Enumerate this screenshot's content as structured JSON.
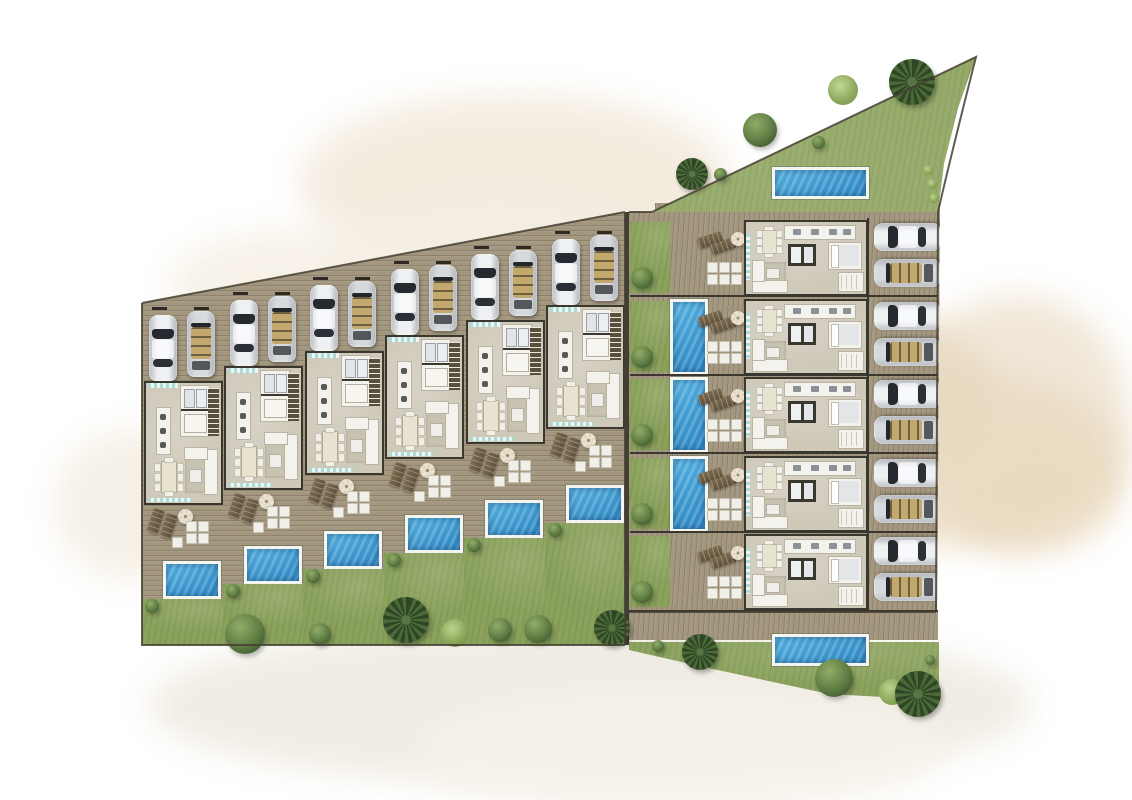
{
  "scene": {
    "title": "Villa development master site plan — watercolor architectural rendering, top view",
    "background_color": "#ffffff",
    "wash_colors": [
      "#f2e9da",
      "#e7d8bf",
      "#ead9bd",
      "#f0ebe2",
      "#f4eee3"
    ]
  },
  "left_row": {
    "name": "west terraced villa row",
    "unit_count": 6,
    "units": [
      {
        "id": "L1"
      },
      {
        "id": "L2"
      },
      {
        "id": "L3"
      },
      {
        "id": "L4"
      },
      {
        "id": "L5"
      },
      {
        "id": "L6"
      }
    ],
    "unit_features": {
      "parking_cars": [
        "white sedan",
        "silver convertible with tan interior"
      ],
      "rooms": [
        "entry with glazing",
        "bathroom and closet rooms",
        "staircase",
        "kitchen island",
        "dining table for 8",
        "living sofa set with rug"
      ],
      "terrace": [
        "2 sun loungers",
        "parasol",
        "outdoor cushion set"
      ],
      "private_pool": "rectangular pool with white surround",
      "garden": "rear lawn with shrub"
    }
  },
  "right_column": {
    "name": "east terraced villa column",
    "unit_count": 5,
    "units": [
      {
        "id": "R1",
        "side_pool": false,
        "nearest_pool": "north amenity pool"
      },
      {
        "id": "R2",
        "side_pool": true
      },
      {
        "id": "R3",
        "side_pool": true
      },
      {
        "id": "R4",
        "side_pool": true
      },
      {
        "id": "R5",
        "side_pool": false,
        "nearest_pool": "south amenity pool"
      }
    ],
    "unit_features": {
      "parking_cars": [
        "silver sedan",
        "silver convertible with tan interior"
      ],
      "rooms": [
        "glazed pool-side facade",
        "dining table for 8",
        "kitchen counter",
        "bathroom core",
        "bedroom",
        "wardrobe",
        "living sofa set with rug"
      ],
      "deck": [
        "2 sun loungers",
        "parasol",
        "outdoor cushion set"
      ],
      "side_garden": "lawn strip with shrub and long plunge pool (units R2–R4)"
    }
  },
  "amenities": {
    "north_garden": {
      "shape": "triangular lawn at top-right",
      "pool": "rectangular amenity pool",
      "planting": [
        "palm tree",
        "fern",
        "round tree",
        "shrubs"
      ]
    },
    "south_garden": {
      "shape": "sloping lawn band at bottom-right with boardwalk",
      "pool": "rectangular amenity pool",
      "planting": [
        "palm trees",
        "round tree",
        "fern",
        "shrubs"
      ]
    },
    "west_garden_edge": {
      "planting": [
        "round bushes",
        "palm trees",
        "ferns"
      ]
    }
  },
  "totals": {
    "villas": 11,
    "pools": 11,
    "cars": 22
  },
  "palette": {
    "deck_wood": "#a3977f",
    "floor": "#cfc9ba",
    "wall": "#3a372e",
    "pool_water": "#3b9ad4",
    "pool_frame": "#f4f5f1",
    "lawn": "#8ba25d",
    "shrub": "#5d7a42",
    "car_silver": "#d7dadd",
    "car_white": "#eef0f2",
    "car_interior_tan": "#c3a86e",
    "glass_teal": "#9fd6d2",
    "umbrella": "#e9e1cc",
    "lounger": "#6f5f45"
  }
}
